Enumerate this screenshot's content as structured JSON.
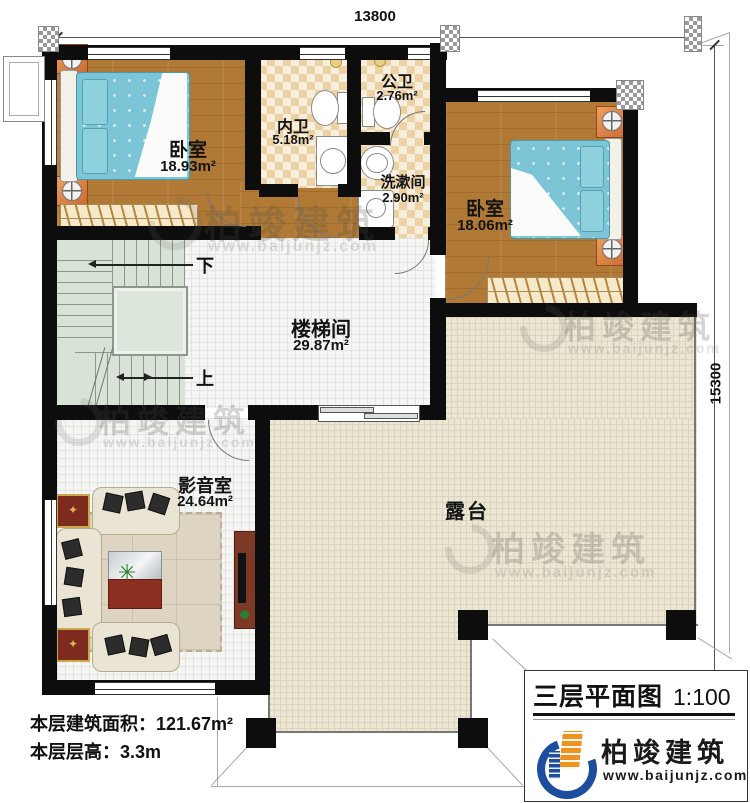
{
  "plan": {
    "dimensions": {
      "top": "13800",
      "right": "15300"
    },
    "rooms": {
      "bedroom_left": {
        "name": "卧室",
        "area": "18.93m²"
      },
      "inner_bath": {
        "name": "内卫",
        "area": "5.18m²"
      },
      "public_bath": {
        "name": "公卫",
        "area": "2.76m²"
      },
      "washroom": {
        "name": "洗漱间",
        "area": "2.90m²"
      },
      "bedroom_right": {
        "name": "卧室",
        "area": "18.06m²"
      },
      "stair_hall": {
        "name": "楼梯间",
        "area": "29.87m²"
      },
      "media_room": {
        "name": "影音室",
        "area": "24.64m²"
      },
      "terrace": {
        "name": "露台"
      }
    },
    "stairs": {
      "down_label": "下",
      "up_label": "上"
    },
    "info": {
      "floor_area": "本层建筑面积：121.67m²",
      "floor_height": "本层层高：3.3m"
    },
    "title_block": {
      "title": "三层平面图",
      "scale": "1:100",
      "brand": "柏竣建筑",
      "website": "www.baijunjz.com"
    },
    "watermark": {
      "brand": "柏竣建筑",
      "website": "www.baijunjz.com"
    },
    "colors": {
      "brand_blue": "#1d4e9e",
      "brand_orange": "#f0921e",
      "wall": "#0d0d0d",
      "wood": "#b07a36",
      "terrace": "#ece7d4"
    }
  }
}
